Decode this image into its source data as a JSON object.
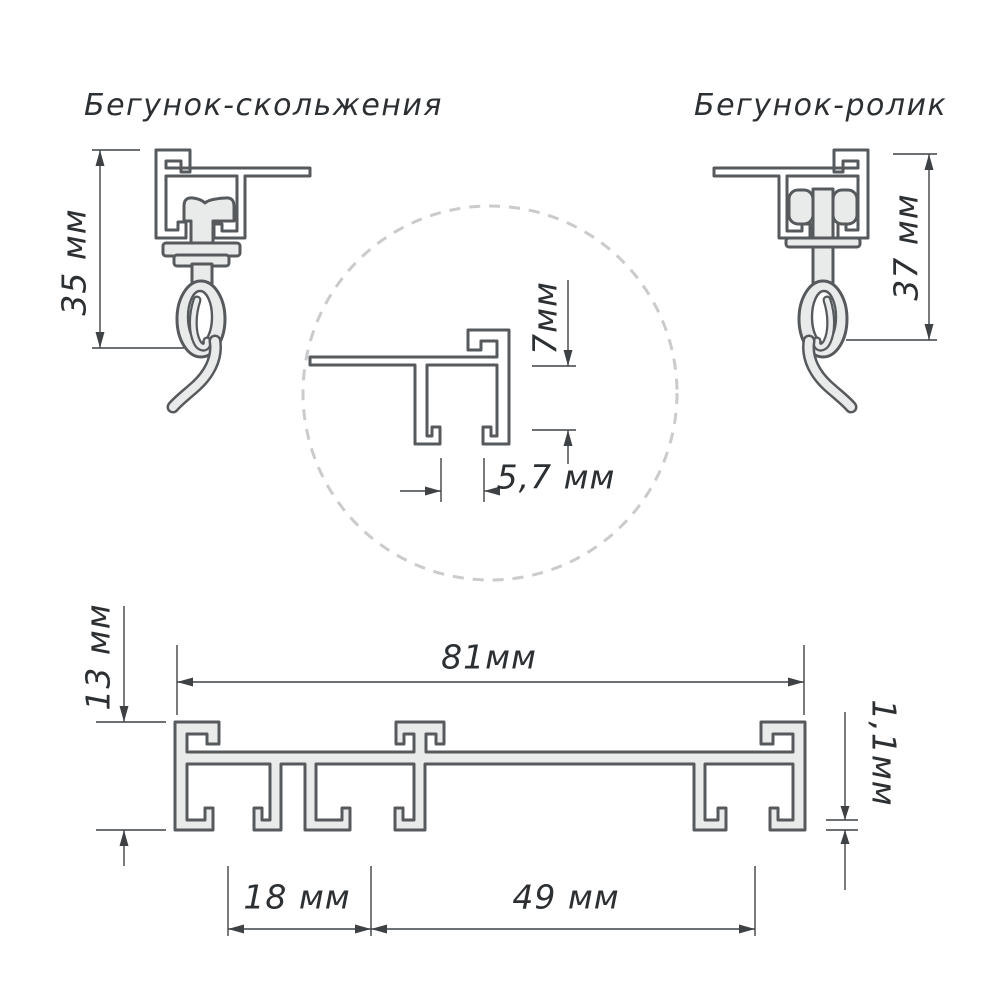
{
  "titles": {
    "left": "Бегунок-скольжения",
    "right": "Бегунок-ролик"
  },
  "dimensions": {
    "runner_slide_height": "35 мм",
    "runner_roller_height": "37 мм",
    "detail_channel_height": "7мм",
    "detail_slot_width": "5,7 мм",
    "profile_height": "13 мм",
    "profile_width": "81мм",
    "profile_wall_thickness": "1,1мм",
    "channel_spacing_left": "18 мм",
    "channel_spacing_right": "49 мм"
  },
  "colors": {
    "outline": "#565a5d",
    "fill": "#e9eaea",
    "dim": "#3f4245",
    "text": "#2d3033",
    "dash": "#c9cbcc",
    "bg": "#ffffff"
  }
}
